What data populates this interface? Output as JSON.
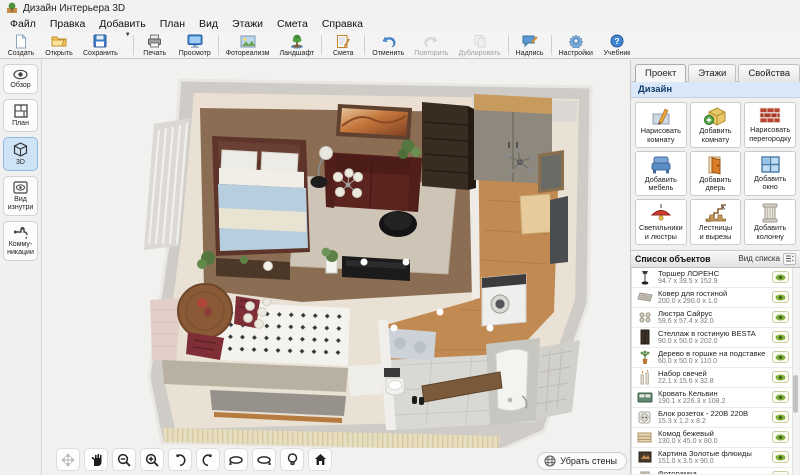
{
  "window": {
    "title": "Дизайн Интерьера 3D",
    "app_icon": "interior-design-app-icon"
  },
  "menubar": {
    "items": [
      "Файл",
      "Правка",
      "Добавить",
      "План",
      "Вид",
      "Этажи",
      "Смета",
      "Справка"
    ]
  },
  "toolbar": {
    "buttons": [
      {
        "label": "Создать",
        "icon": "new-file-icon",
        "enabled": true
      },
      {
        "label": "Открыть",
        "icon": "open-folder-icon",
        "enabled": true
      },
      {
        "label": "Сохранить",
        "icon": "save-floppy-icon",
        "enabled": true,
        "has_dropdown": true
      },
      {
        "label": "Печать",
        "icon": "print-icon",
        "enabled": true
      },
      {
        "label": "Просмотр",
        "icon": "preview-monitor-icon",
        "enabled": true
      },
      {
        "label": "Фотореализм",
        "icon": "photorealism-icon",
        "enabled": true
      },
      {
        "label": "Ландшафт",
        "icon": "landscape-tree-icon",
        "enabled": true
      },
      {
        "label": "Смета",
        "icon": "estimate-notepad-icon",
        "enabled": true
      },
      {
        "label": "Отменить",
        "icon": "undo-icon",
        "enabled": true
      },
      {
        "label": "Повторить",
        "icon": "redo-icon",
        "enabled": false
      },
      {
        "label": "Дублировать",
        "icon": "duplicate-icon",
        "enabled": false
      },
      {
        "label": "Надпись",
        "icon": "text-label-icon",
        "enabled": true
      },
      {
        "label": "Настройки",
        "icon": "settings-gear-icon",
        "enabled": true
      },
      {
        "label": "Учебник",
        "icon": "tutorial-help-icon",
        "enabled": true
      }
    ]
  },
  "sidebar": {
    "items": [
      {
        "label": "Обзор",
        "icon": "overview-eye-icon",
        "active": false
      },
      {
        "label": "План",
        "icon": "plan-2d-icon",
        "active": false
      },
      {
        "label": "3D",
        "icon": "cube-3d-icon",
        "active": true
      },
      {
        "label": "Вид\nизнутри",
        "icon": "inside-view-icon",
        "active": false
      },
      {
        "label": "Комму-\nникации",
        "icon": "plumbing-icon",
        "active": false
      }
    ]
  },
  "panel": {
    "tabs": [
      {
        "label": "Проект",
        "active": true
      },
      {
        "label": "Этажи",
        "active": false
      },
      {
        "label": "Свойства",
        "active": false
      }
    ],
    "section_title": "Дизайн",
    "design_buttons": [
      {
        "label": "Нарисовать\nкомнату",
        "icon": "draw-room-icon"
      },
      {
        "label": "Добавить\nкомнату",
        "icon": "add-room-icon"
      },
      {
        "label": "Нарисовать\nперегородку",
        "icon": "draw-partition-icon"
      },
      {
        "label": "Добавить\nмебель",
        "icon": "add-furniture-icon"
      },
      {
        "label": "Добавить\nдверь",
        "icon": "add-door-icon"
      },
      {
        "label": "Добавить\nокно",
        "icon": "add-window-icon"
      },
      {
        "label": "Светильники\nи люстры",
        "icon": "lamps-icon"
      },
      {
        "label": "Лестницы\nи вырезы",
        "icon": "stairs-icon"
      },
      {
        "label": "Добавить\nколонну",
        "icon": "add-column-icon"
      }
    ],
    "object_list": {
      "title": "Список объектов",
      "view_label": "Вид списка",
      "items": [
        {
          "name": "Торшер ЛОРЕНС",
          "dims": "94.7 x 39.5 x 152.9",
          "thumb": "floor-lamp"
        },
        {
          "name": "Ковер для гостиной",
          "dims": "200.0 x 290.0 x 1.0",
          "thumb": "rug"
        },
        {
          "name": "Люстра Сайрус",
          "dims": "59.6 x 57.4 x 32.0",
          "thumb": "chandelier"
        },
        {
          "name": "Стеллаж в гостиную BESTA",
          "dims": "90.0 x 50.0 x 202.0",
          "thumb": "shelf"
        },
        {
          "name": "Дерево в горшке на подставке",
          "dims": "60.0 x 50.0 x 110.0",
          "thumb": "plant"
        },
        {
          "name": "Набор свечей",
          "dims": "22.1 x 15.6 x 32.8",
          "thumb": "candles"
        },
        {
          "name": "Кровать Кельвин",
          "dims": "190.1 x 226.3 x 108.2",
          "thumb": "bed"
        },
        {
          "name": "Блок розеток - 220В 220В",
          "dims": "15.3 x 1.2 x 8.2",
          "thumb": "socket"
        },
        {
          "name": "Комод бежевый",
          "dims": "130.0 x 45.0 x 80.0",
          "thumb": "dresser"
        },
        {
          "name": "Картина Золотые флюиды",
          "dims": "151.0 x 3.5 x 90.0",
          "thumb": "painting"
        },
        {
          "name": "Фоторамка",
          "dims": "12.2 x 3.0 x 17.2",
          "thumb": "photo-frame"
        }
      ]
    }
  },
  "viewport": {
    "remove_walls_label": "Убрать стены",
    "nav_tools": [
      "move-tool-icon",
      "pan-hand-icon",
      "zoom-out-icon",
      "zoom-in-icon",
      "rotate-ccw-icon",
      "rotate-cw-icon",
      "orbit-left-icon",
      "orbit-right-icon",
      "light-icon",
      "home-view-icon"
    ]
  },
  "colors": {
    "active_sidebar_bg": "#cfe3f6",
    "design_header_bg": "#d9e7f8",
    "eye_green": "#5f8f2f",
    "sofa": "#5c241e",
    "bed_blanket": "#b6cedd",
    "wood_floor": "#8a6d52",
    "hall_floor": "#c18a52",
    "wall_gray": "#cfccc7"
  }
}
